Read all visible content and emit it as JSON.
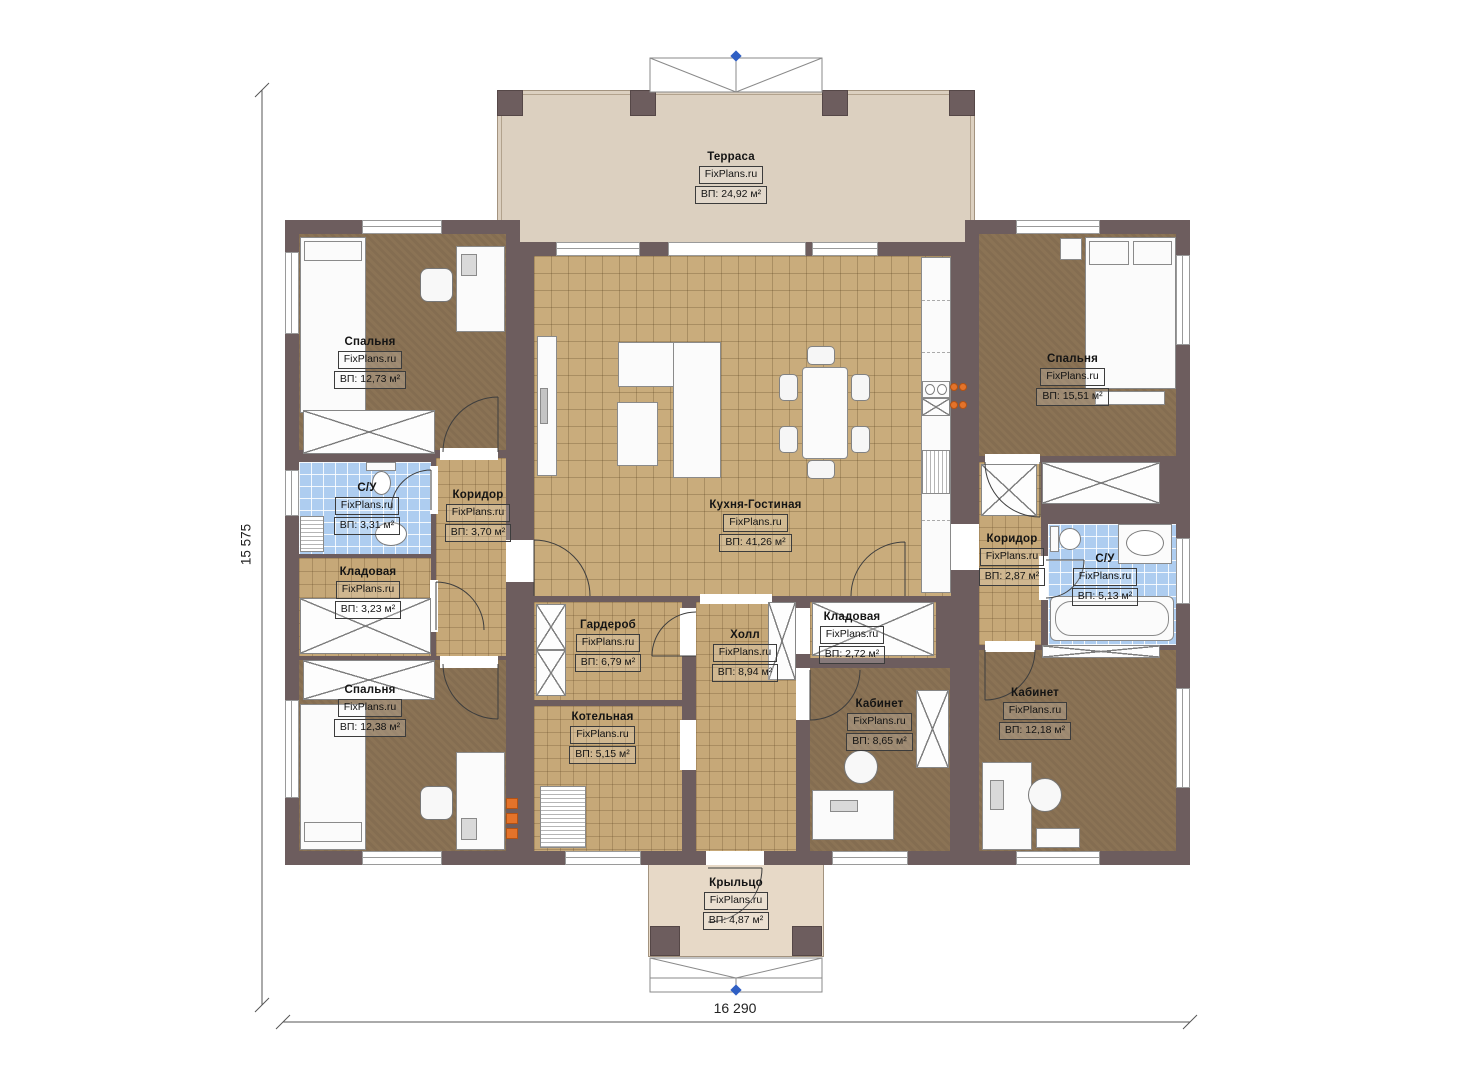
{
  "plan": {
    "brand": "FixPlans.ru",
    "dimensions": {
      "width": "16 290",
      "height": "15 575"
    },
    "rooms": {
      "terrace": {
        "name": "Терраса",
        "area": "ВП: 24,92 м²"
      },
      "bedroom_top_left": {
        "name": "Спальня",
        "area": "ВП: 12,73 м²"
      },
      "bathroom_left": {
        "name": "С/У",
        "area": "ВП: 3,31 м²"
      },
      "corridor_left": {
        "name": "Коридор",
        "area": "ВП: 3,70 м²"
      },
      "pantry_left": {
        "name": "Кладовая",
        "area": "ВП: 3,23 м²"
      },
      "bedroom_bottom_left": {
        "name": "Спальня",
        "area": "ВП: 12,38 м²"
      },
      "kitchen_living": {
        "name": "Кухня-Гостиная",
        "area": "ВП: 41,26 м²"
      },
      "wardrobe": {
        "name": "Гардероб",
        "area": "ВП: 6,79 м²"
      },
      "boiler_room": {
        "name": "Котельная",
        "area": "ВП: 5,15 м²"
      },
      "hall": {
        "name": "Холл",
        "area": "ВП: 8,94 м²"
      },
      "pantry_right": {
        "name": "Кладовая",
        "area": "ВП: 2,72 м²"
      },
      "office_small": {
        "name": "Кабинет",
        "area": "ВП: 8,65 м²"
      },
      "office_large": {
        "name": "Кабинет",
        "area": "ВП: 12,18 м²"
      },
      "bedroom_top_right": {
        "name": "Спальня",
        "area": "ВП: 15,51 м²"
      },
      "corridor_right": {
        "name": "Коридор",
        "area": "ВП: 2,87 м²"
      },
      "bathroom_right": {
        "name": "С/У",
        "area": "ВП: 5,13 м²"
      },
      "porch": {
        "name": "Крыльцо",
        "area": "ВП: 4,87 м²"
      }
    }
  }
}
